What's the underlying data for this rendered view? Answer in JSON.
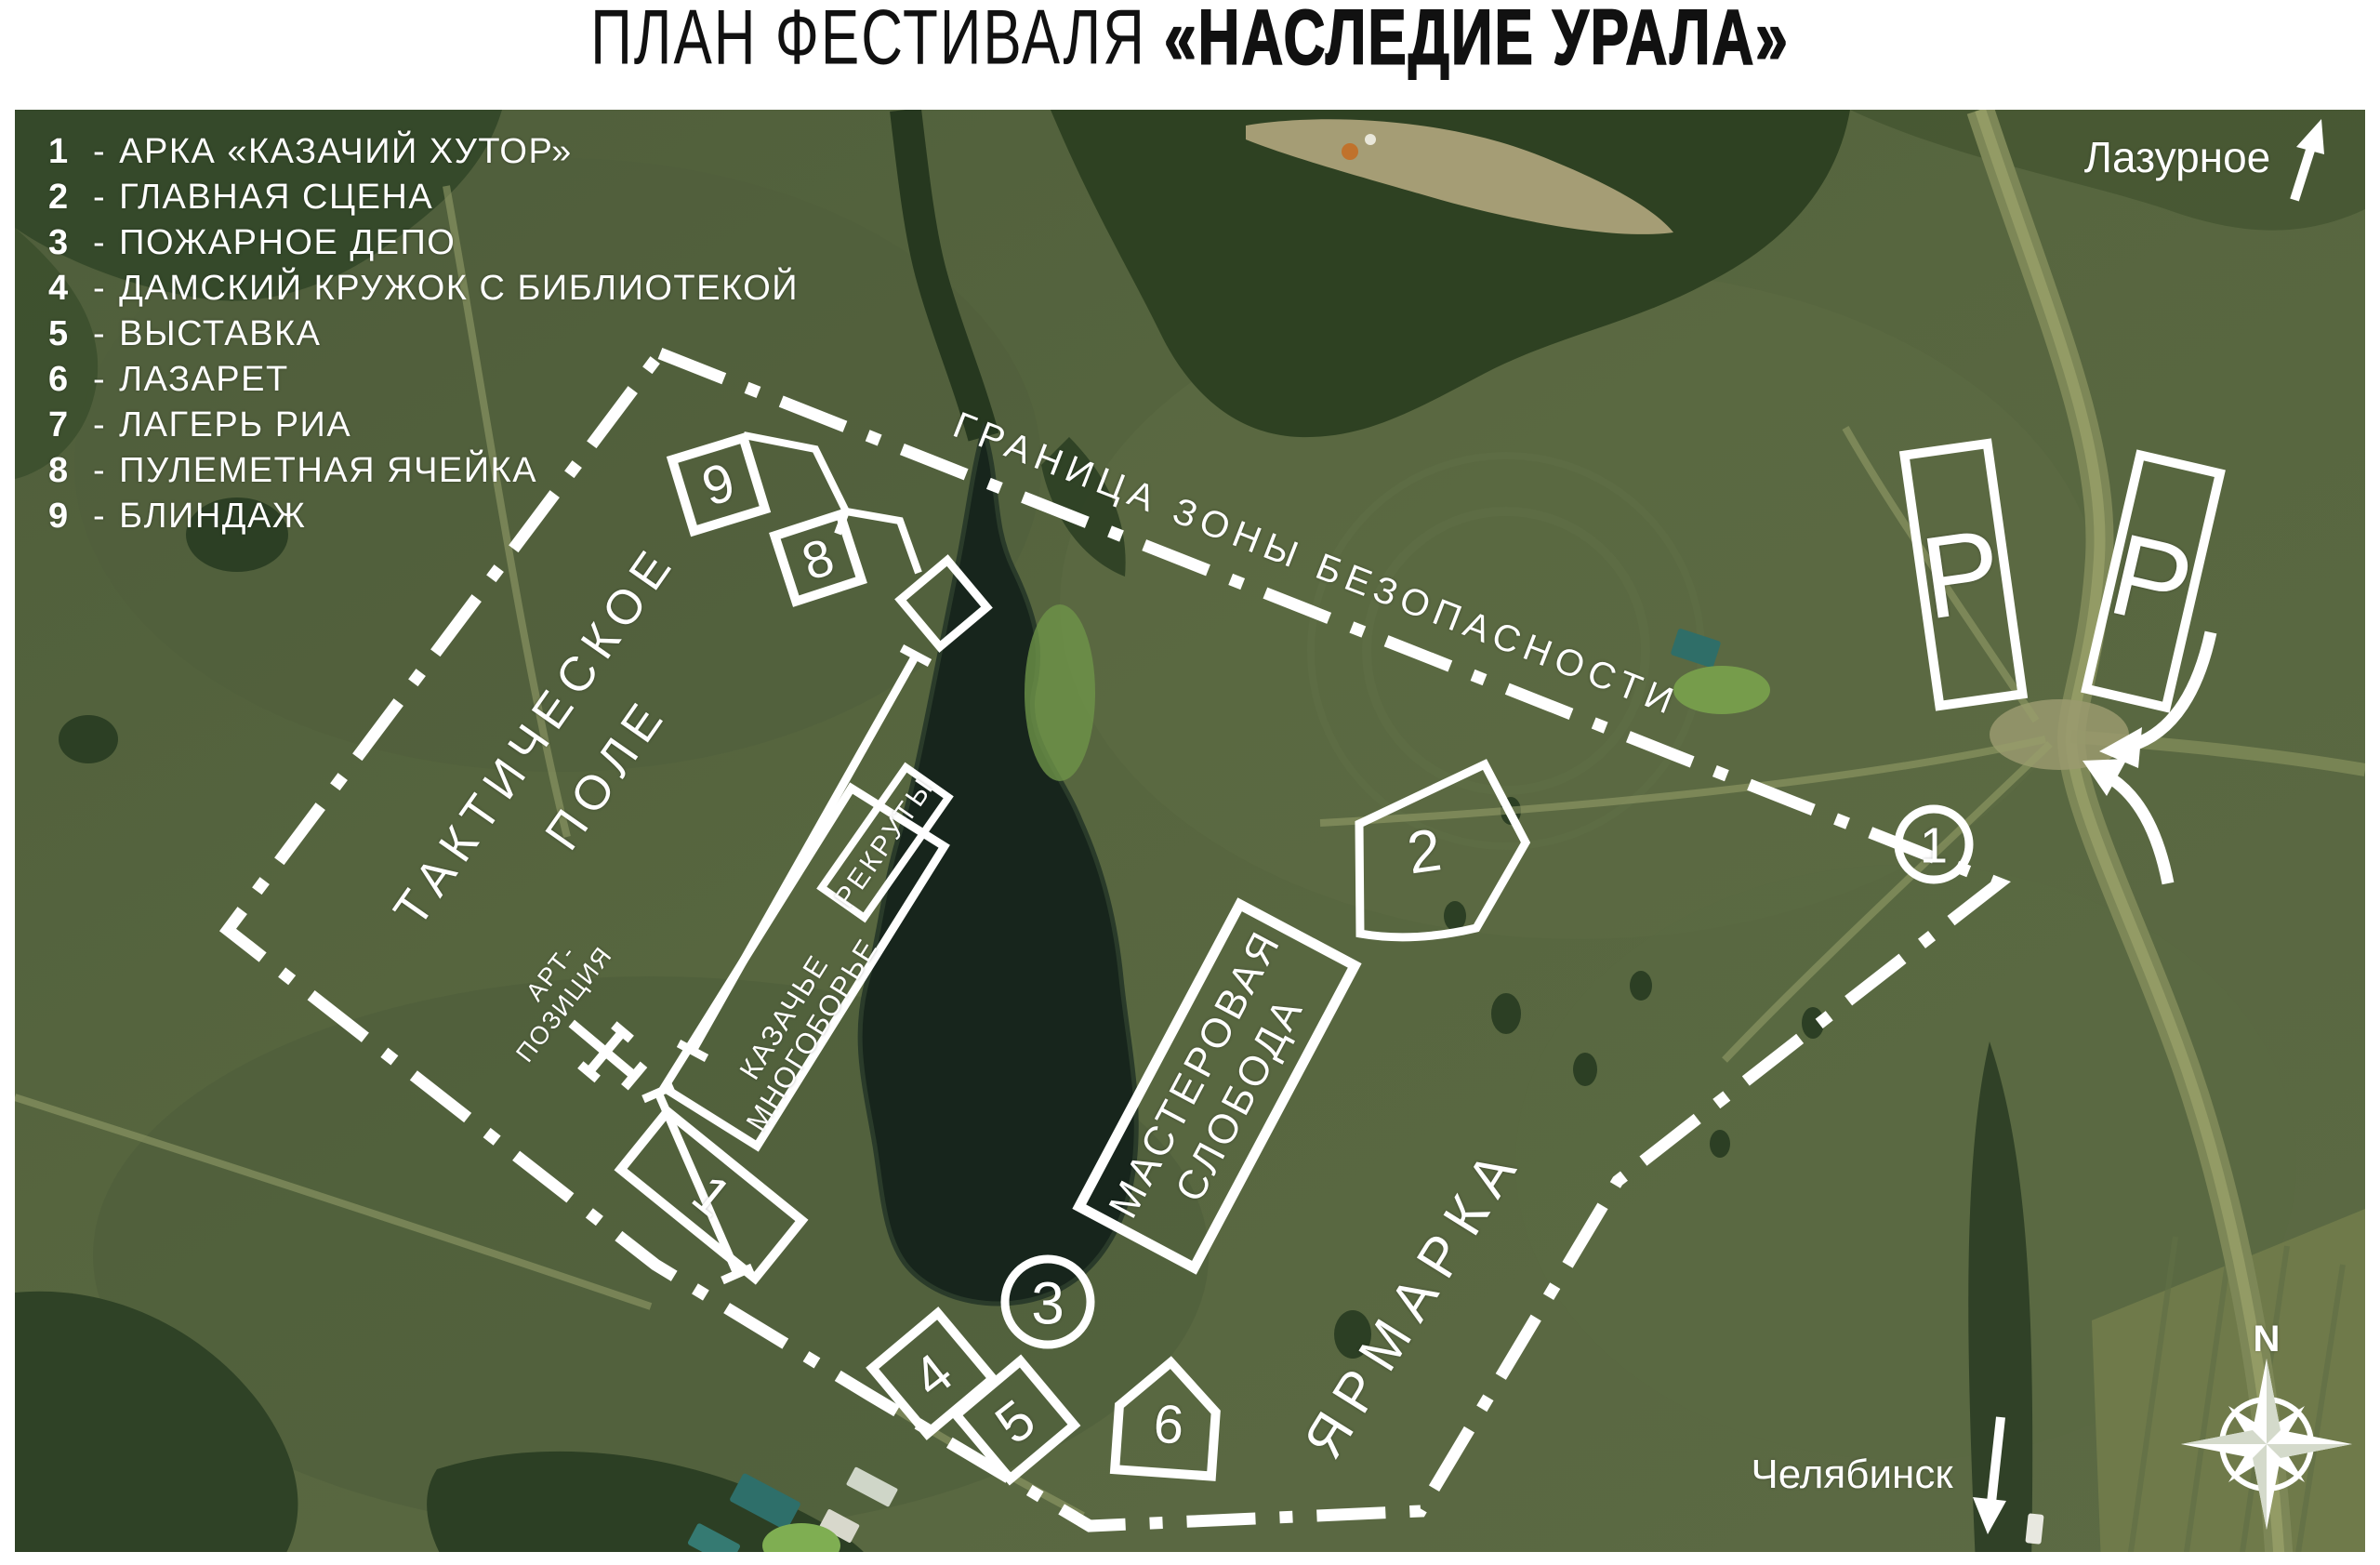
{
  "title": {
    "prefix": "ПЛАН ФЕСТИВАЛЯ ",
    "highlight": "«НАСЛЕДИЕ УРАЛА»"
  },
  "legend": {
    "separator": "-",
    "items": [
      {
        "num": "1",
        "label": "АРКА «КАЗАЧИЙ ХУТОР»"
      },
      {
        "num": "2",
        "label": "ГЛАВНАЯ СЦЕНА"
      },
      {
        "num": "3",
        "label": "ПОЖАРНОЕ ДЕПО"
      },
      {
        "num": "4",
        "label": "ДАМСКИЙ КРУЖОК С БИБЛИОТЕКОЙ"
      },
      {
        "num": "5",
        "label": "ВЫСТАВКА"
      },
      {
        "num": "6",
        "label": "ЛАЗАРЕТ"
      },
      {
        "num": "7",
        "label": "ЛАГЕРЬ РИА"
      },
      {
        "num": "8",
        "label": "ПУЛЕМЕТНАЯ ЯЧЕЙКА"
      },
      {
        "num": "9",
        "label": "БЛИНДАЖ"
      }
    ]
  },
  "map_labels": {
    "boundary": "ГРАНИЦА ЗОНЫ БЕЗОПАСНОСТИ",
    "tactical_1": "ТАКТИЧЕСКОЕ",
    "tactical_2": "ПОЛЕ",
    "art_1": "АРТ-",
    "art_2": "ПОЗИЦИЯ",
    "cossack_1": "КАЗАЧЬЕ",
    "cossack_2": "МНОГОБОРЬЕ",
    "recruits": "РЕКРУТЫ",
    "craft_1": "МАСТЕРОВАЯ",
    "craft_2": "СЛОБОДА",
    "fair": "ЯРМАРКА"
  },
  "markers": {
    "m1": "1",
    "m2": "2",
    "m3": "3",
    "m4": "4",
    "m5": "5",
    "m6": "6",
    "m8": "8",
    "m9": "9"
  },
  "parking": {
    "label": "P"
  },
  "directions": {
    "north": "N",
    "city_top": "Лазурное",
    "city_bottom": "Челябинск"
  },
  "colors": {
    "overlay_white": "#ffffff",
    "title_black": "#111111",
    "field_green": "#55643f",
    "forest_green": "#2e4122",
    "water_dark": "#17251c",
    "road_pale": "#8e9663"
  }
}
